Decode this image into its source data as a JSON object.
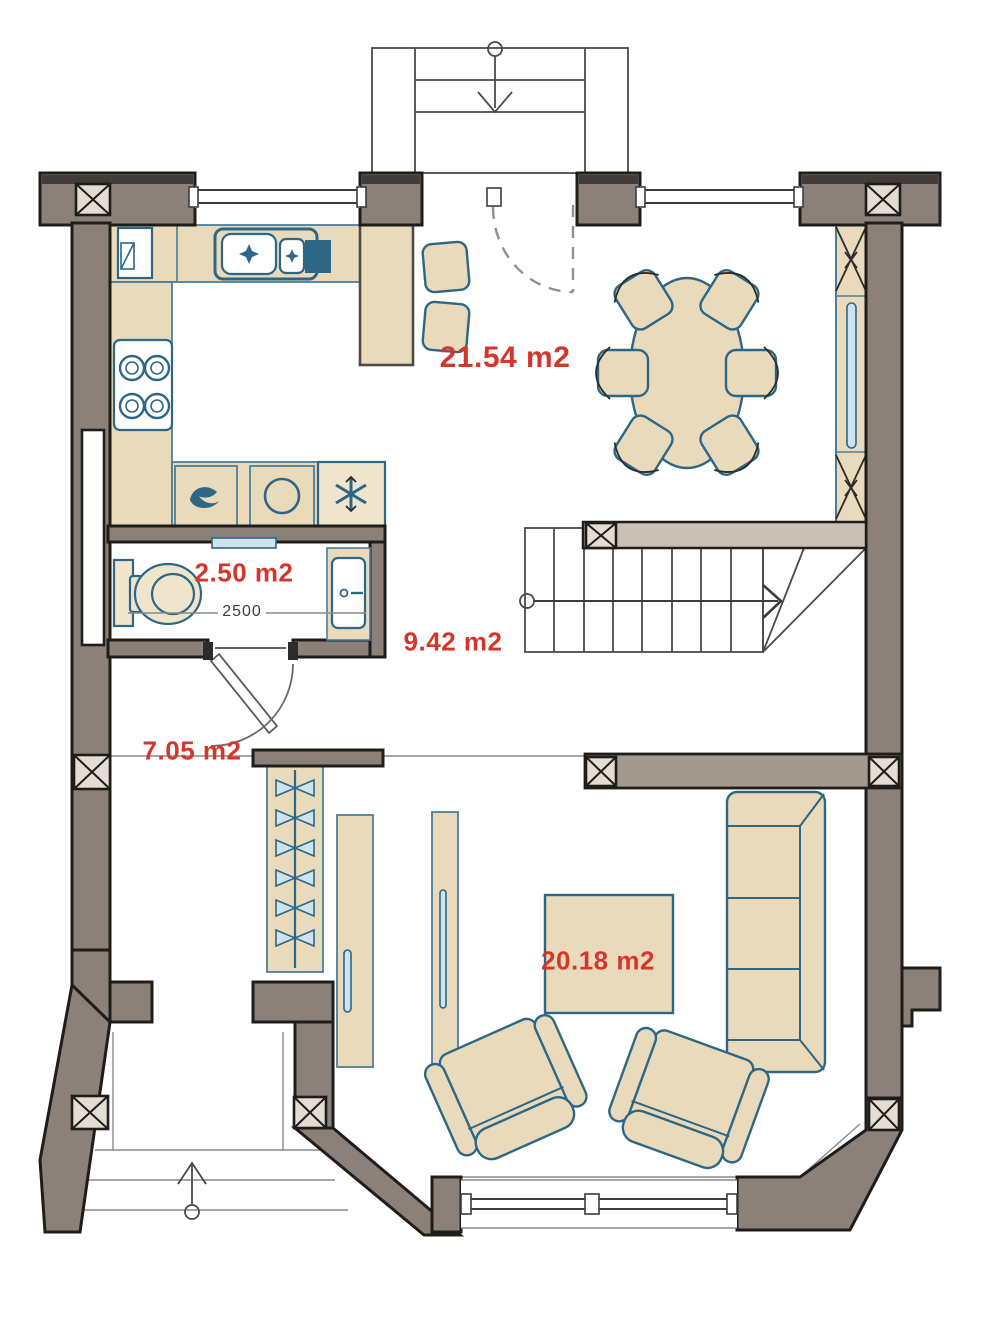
{
  "labels": {
    "kitchen_dining": "21.54 m2",
    "bathroom": "2.50 m2",
    "bathroom_dimension": "2500",
    "stair_hall": "9.42 m2",
    "hallway": "7.05 m2",
    "living_room": "20.18 m2"
  },
  "colors": {
    "wall": "#8b8178",
    "wall_light": "#c9c1b5",
    "furniture_fill": "#e8dabb",
    "furniture_outline": "#2d6785",
    "counter_outline": "#4b7f99",
    "accent_fill": "#cfe3ec",
    "area_label_red": "#d6352c"
  },
  "fixtures": {
    "kitchen": [
      "tall-cabinet",
      "double-sink",
      "cooktop-4-burners",
      "bar-counter",
      "bar-stool",
      "bar-stool",
      "washing-machine",
      "round-appliance",
      "freezer"
    ],
    "bathroom": [
      "toilet",
      "washbasin",
      "shelf"
    ],
    "dining": [
      "oval-table",
      "six-chairs",
      "radiator"
    ],
    "hallway": [
      "coat-hanger-rack",
      "tall-cabinet",
      "wardrobe-panel"
    ],
    "living_room": [
      "coffee-table",
      "three-seat-sofa",
      "armchair",
      "armchair"
    ],
    "circulation": [
      "staircase-up-arrow",
      "entrance-door",
      "bathroom-door",
      "front-porch-steps",
      "rear-porch-steps"
    ]
  }
}
